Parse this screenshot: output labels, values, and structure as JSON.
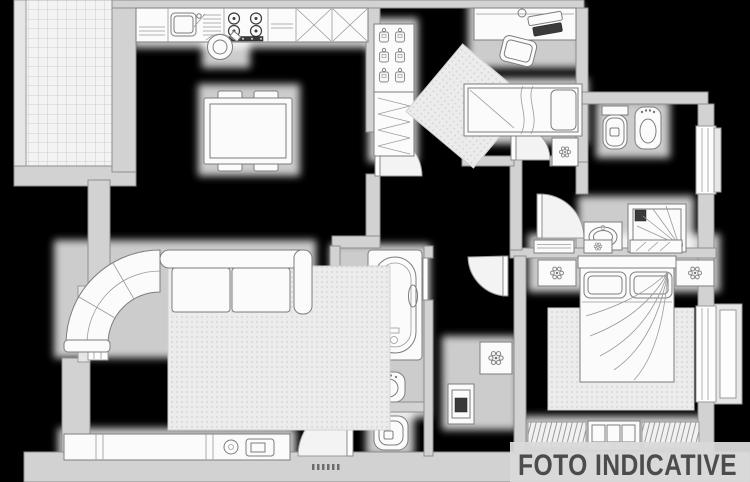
{
  "watermark": {
    "label": "FOTO INDICATIVE"
  },
  "palette": {
    "background": "#000000",
    "wall_fill": "#d2d2d2",
    "wall_edge": "#8e8e8e",
    "furniture_fill": "#fbfbfb",
    "furniture_stroke": "#7d7d7d",
    "accent_dark": "#3a3a3a",
    "halo": "#ffffff",
    "watermark_color": "#4c4c4c",
    "watermark_panel": "#d9d9d9"
  },
  "rooms": [
    {
      "name": "balcony",
      "elements": [
        "tiled-floor",
        "railing"
      ]
    },
    {
      "name": "kitchen-living",
      "elements": [
        "kitchen-counter",
        "sink",
        "cooktop",
        "corner-cabinets",
        "dining-table",
        "chair",
        "corner-sofa",
        "area-rug",
        "sideboard",
        "tv-unit",
        "left-window"
      ]
    },
    {
      "name": "bedroom-2",
      "elements": [
        "wardrobe",
        "desk",
        "desk-chair",
        "single-bed",
        "nightstand",
        "rug"
      ]
    },
    {
      "name": "bathroom-1",
      "elements": [
        "toilet",
        "bidet",
        "washbasin",
        "corner-shower",
        "window"
      ]
    },
    {
      "name": "bathroom-2",
      "elements": [
        "vanity-cabinet",
        "bathtub",
        "bidet",
        "toilet"
      ]
    },
    {
      "name": "hallway",
      "elements": [
        "storage-cabinet",
        "plant-stand",
        "door-arcs"
      ]
    },
    {
      "name": "master-bedroom",
      "elements": [
        "dressers",
        "nightstands",
        "double-bed",
        "rug",
        "curtained-window",
        "radiator",
        "bay-window"
      ]
    },
    {
      "name": "entrance",
      "elements": [
        "entry-door"
      ]
    }
  ]
}
